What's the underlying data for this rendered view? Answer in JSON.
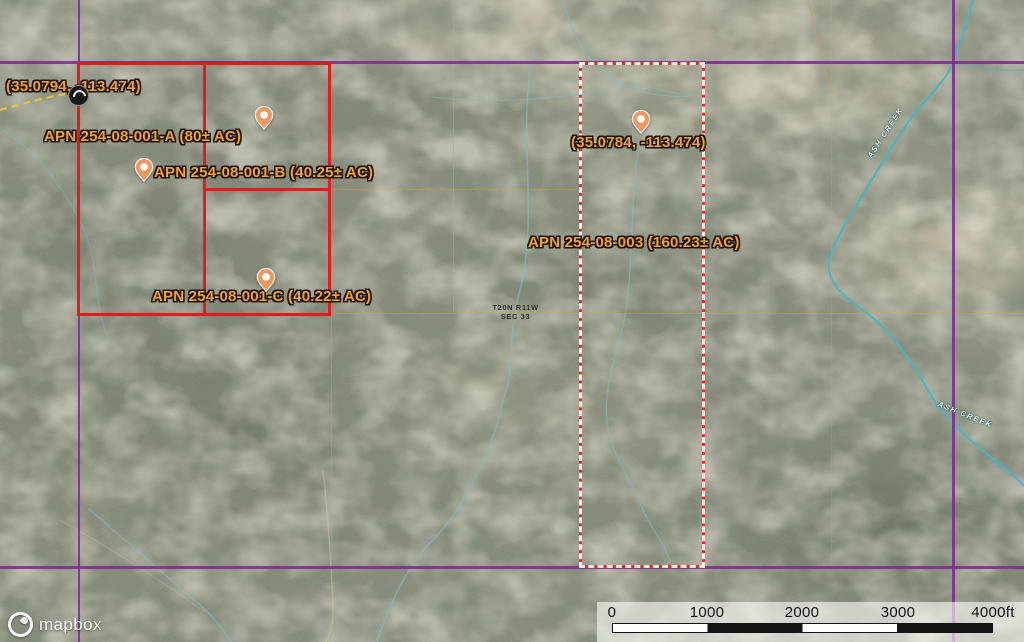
{
  "map": {
    "coordinate_labels": [
      {
        "text": "(35.0794, -113.474)"
      },
      {
        "text": "(35.0784, -113.474)"
      }
    ],
    "parcels": [
      {
        "label": "APN 254-08-001-A (80± AC)"
      },
      {
        "label": "APN 254-08-001-B (40.25± AC)"
      },
      {
        "label": "APN 254-08-001-C (40.22± AC)"
      },
      {
        "label": "APN 254-08-003 (160.23± AC)"
      }
    ],
    "section_label": {
      "line1": "T20N R11W",
      "line2": "SEC 33"
    },
    "creek_label_upper": "ASH CREEK",
    "creek_label_lower": "ASH CREEK"
  },
  "scale_bar": {
    "ticks": [
      "0",
      "1000",
      "2000",
      "3000",
      "4000ft"
    ]
  },
  "attribution": {
    "logo_text": "mapbox"
  },
  "colors": {
    "parcel_outline_red": "#e8191d",
    "boundary_purple": "#7a2d8e",
    "label_orange": "#efa42f",
    "creek_teal": "#4ab4c4",
    "marker_fill": "#ef9760",
    "section_line_orange": "#d6a546"
  }
}
